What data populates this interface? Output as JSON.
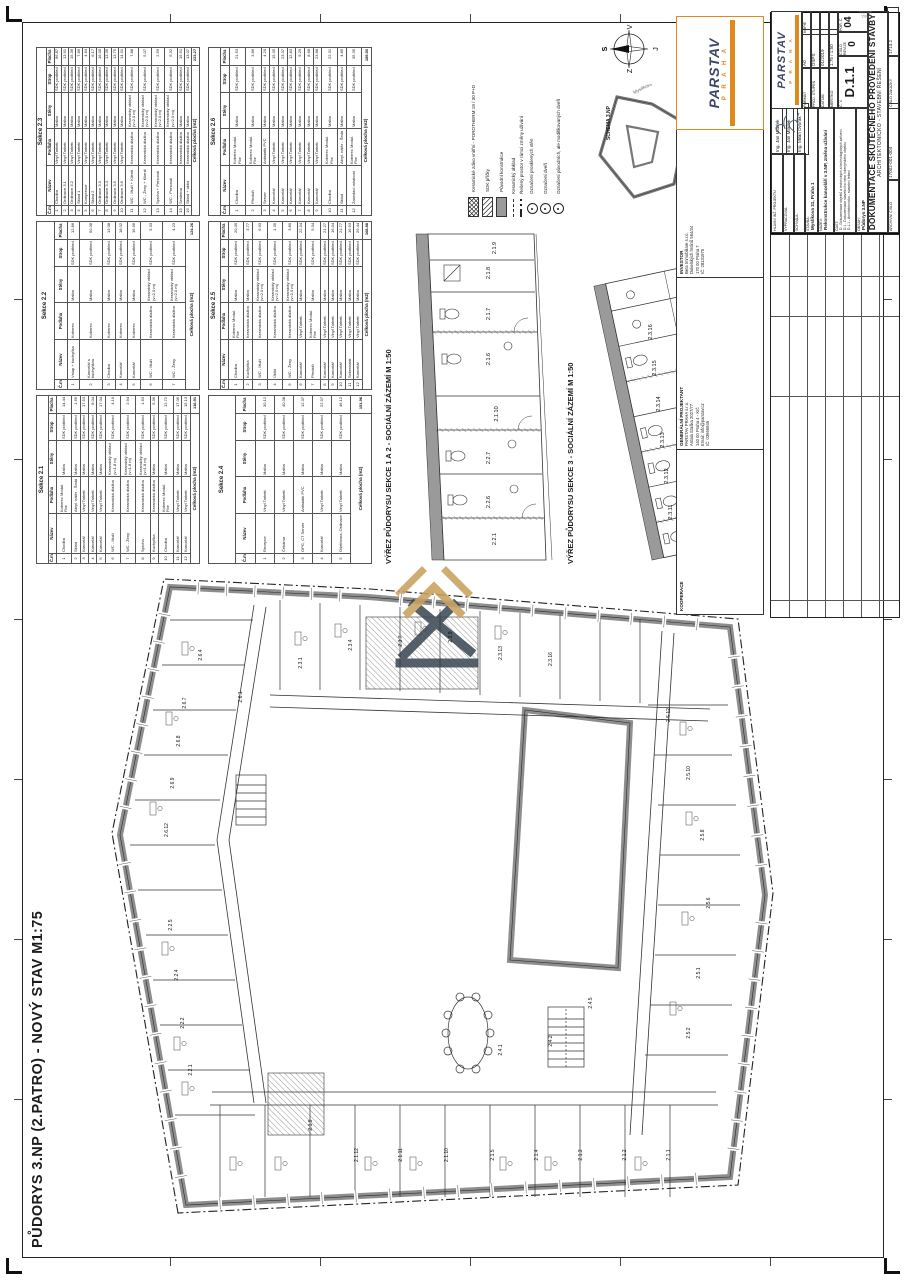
{
  "sheet": {
    "main_title": "PŮDORYS 3.NP (2.PATRO) - NOVÝ STAV M1:75",
    "detail1_title": "VÝŘEZ PŮDORYSU SEKCE 1 A 2 - SOCIÁLNÍ ZÁZEMÍ M 1:50",
    "detail2_title": "VÝŘEZ PŮDORYSU SEKCE 3 - SOCIÁLNÍ ZÁZEMÍ M 1:50",
    "schema_label": "SCHEMA 3.NP",
    "edge_stamp": "17002-001-004"
  },
  "compass": {
    "n": "S",
    "e": "V",
    "s": "J",
    "w": "Z"
  },
  "schema": {
    "streets": [
      "Černá",
      "Myslíkova"
    ]
  },
  "legend": {
    "items": [
      {
        "sw": "cross",
        "label": "Keramické zdivo vnitřní - POROTHERM 19 / 30 P+D"
      },
      {
        "sw": "diag",
        "label": "SDK příčky"
      },
      {
        "sw": "solid",
        "label": "Původní konstrukce"
      },
      {
        "sw": "lineD",
        "label": "Keramický obklad"
      },
      {
        "sw": "dd",
        "label": "Řešený prostor v rámci změny užívání"
      },
      {
        "sw": "circ",
        "label": "Označení prosklených stěn"
      },
      {
        "sw": "circ",
        "label": "Označení dveří"
      },
      {
        "sw": "circ",
        "label": "Označení původních, ale modifikovaných dveří"
      }
    ]
  },
  "tables": {
    "columns": [
      "Č.m.",
      "Název",
      "Podlaha",
      "Stěny",
      "Strop",
      "Plocha"
    ],
    "total_label": "Celková plocha (m2)",
    "sections": [
      {
        "name": "Sekce 2.1",
        "total": "116.91",
        "rows": [
          [
            "1",
            "Chodba",
            "Koberec Modul. Flor",
            "Malba",
            "SDK podhled",
            "14.44"
          ],
          [
            "2",
            "Sklad",
            "Akryl. nátěr - Šedá",
            "Malba",
            "SDK podhled",
            "1.69"
          ],
          [
            "3",
            "Kancelář",
            "Vinyl Tarkett",
            "Malba",
            "SDK podhled",
            "17.53"
          ],
          [
            "4",
            "Kancelář",
            "Vinyl Tarkett",
            "Malba",
            "SDK podhled",
            "8.04"
          ],
          [
            "5",
            "Kancelář",
            "Vinyl Tarkett",
            "Malba",
            "SDK podhled",
            "17.04"
          ],
          [
            "6",
            "WC - Muži",
            "Keramická dlažba",
            "Keramický obklad (v=1.8 m)",
            "SDK podhled",
            "4.19"
          ],
          [
            "7",
            "WC - Ženy",
            "Keramická dlažba",
            "Keramický obklad (v=1.8 m)",
            "SDK podhled",
            "2.94"
          ],
          [
            "8",
            "Sprcha",
            "Keramická dlažba",
            "Keramický obklad (v=1.8 m)",
            "SDK podhled",
            "1.63"
          ],
          [
            "9",
            "Kuchyňka",
            "Keramická dlažba",
            "Malba",
            "SDK podhled",
            "5.36"
          ],
          [
            "10",
            "Chodba",
            "Koberec Modul. Flor",
            "Malba",
            "SDK podhled",
            "12.72"
          ],
          [
            "11",
            "Kancelář",
            "Vinyl Tarkett",
            "Malba",
            "SDK podhled",
            "17.06"
          ],
          [
            "12",
            "Kancelář",
            "Vinyl Tarkett",
            "Malba",
            "SDK podhled",
            "15.13"
          ]
        ]
      },
      {
        "name": "Sekce 2.2",
        "total": "124.26",
        "rows": [
          [
            "1",
            "Vstup + kuchyňka",
            "Koberec",
            "Malba",
            "SDK podhled",
            "12.86"
          ],
          [
            "2",
            "Kancelář s kuchyňkou",
            "Koberec",
            "Malba",
            "SDK podhled",
            "50.38"
          ],
          [
            "3",
            "Chodba",
            "Koberec",
            "Malba",
            "SDK podhled",
            "13.08"
          ],
          [
            "4",
            "Kancelář",
            "Koberec",
            "Malba",
            "SDK podhled",
            "18.02"
          ],
          [
            "5",
            "Kancelář",
            "Koberec",
            "Malba",
            "SDK podhled",
            "16.66"
          ],
          [
            "6",
            "WC - Muži",
            "Keramická dlažba",
            "Keramický obklad (v=2.0 m)",
            "SDK podhled",
            "5.33"
          ],
          [
            "7",
            "WC - Ženy",
            "Keramická dlažba",
            "Keramický obklad (v=2.0 m)",
            "SDK podhled",
            "4.23"
          ]
        ]
      },
      {
        "name": "Sekce 2.3",
        "total": "223.27",
        "rows": [
          [
            "1",
            "Chodba",
            "Vinyl Tarkett",
            "Malba",
            "SDK podhled",
            "66.87"
          ],
          [
            "2",
            "Ordinace 3.1",
            "Vinyl Tarkett",
            "Malba",
            "SDK podhled",
            "13.91"
          ],
          [
            "3",
            "Ordinace 3.2",
            "Vinyl Tarkett",
            "Malba",
            "SDK podhled",
            "15.36"
          ],
          [
            "4",
            "Sklad 1",
            "Vinyl Tarkett",
            "Malba",
            "SDK podhled",
            "7.86"
          ],
          [
            "5",
            "Kompresor",
            "Vinyl Tarkett",
            "Malba",
            "SDK podhled",
            "4.84"
          ],
          [
            "6",
            "Sklad 2",
            "Vinyl Tarkett",
            "Malba",
            "SDK podhled",
            "6.17"
          ],
          [
            "7",
            "Ordinace 3.3",
            "Vinyl Tarkett",
            "Malba",
            "SDK podhled",
            "16.00"
          ],
          [
            "8",
            "Ordinace 3.4",
            "Vinyl Tarkett",
            "Malba",
            "SDK podhled",
            "13.36"
          ],
          [
            "9",
            "Ordinace 3.5",
            "Vinyl Tarkett",
            "Malba",
            "SDK podhled",
            "13.75"
          ],
          [
            "10",
            "Ordinace 3.6",
            "Vinyl Tarkett",
            "Malba",
            "SDK podhled",
            "14.31"
          ],
          [
            "11",
            "WC - Muži + Klienti",
            "Keramická dlažba",
            "Keramický obklad (v=2.0 m)",
            "SDK podhled",
            "7.88"
          ],
          [
            "12",
            "WC - Ženy + Klienti",
            "Keramická dlažba",
            "Keramický obklad (v=2.0 m)",
            "SDK podhled",
            "5.07"
          ],
          [
            "13",
            "Sprcha + Personál",
            "Keramická dlažba",
            "Keramický obklad (v=2.0 m)",
            "SDK podhled",
            "2.59"
          ],
          [
            "14",
            "WC - Personál",
            "Keramická dlažba",
            "Keramický obklad (v=2.0 m)",
            "SDK podhled",
            "6.32"
          ],
          [
            "15",
            "Sesterna",
            "Keramická dlažba",
            "Malba",
            "SDK podhled",
            "15.91"
          ],
          [
            "16",
            "Sklad + úklid",
            "Keramická dlažba",
            "Malba",
            "SDK podhled",
            "13.07"
          ]
        ]
      },
      {
        "name": "Sekce 2.4",
        "total": "151.96",
        "rows": [
          [
            "1",
            "Recepce",
            "Vinyl Tarkett",
            "Malba",
            "SDK podhled",
            "30.12"
          ],
          [
            "2",
            "Čekárna",
            "Vinyl Tarkett",
            "Malba",
            "SDK podhled",
            "40.38"
          ],
          [
            "3",
            "OPG, CT Server",
            "Antistatik PVC",
            "Malba",
            "SDK podhled",
            "12.37"
          ],
          [
            "4",
            "Kancelář",
            "Vinyl Tarkett",
            "Malba",
            "SDK podhled",
            "22.97"
          ],
          [
            "5",
            "Ošetřovna, Ordinace",
            "Vinyl Tarkett",
            "Malba",
            "SDK podhled",
            "46.12"
          ]
        ]
      },
      {
        "name": "Sekce 2.5",
        "total": "168.88",
        "rows": [
          [
            "1",
            "Chodba",
            "Koberec Modul. Flor",
            "Malba",
            "SDK podhled",
            "20.30"
          ],
          [
            "2",
            "Kuchyňka",
            "Keramická dlažba",
            "Malba",
            "SDK podhled",
            "3.77"
          ],
          [
            "3",
            "WC - Muži",
            "Keramická dlažba",
            "Keramický obklad (v=2.0 m)",
            "SDK podhled",
            "6.93"
          ],
          [
            "4",
            "Úklid",
            "Keramická dlažba",
            "Keramický obklad (v=2.0 m)",
            "SDK podhled",
            "1.35"
          ],
          [
            "5",
            "WC - Ženy",
            "Keramická dlažba",
            "Keramický obklad (v=2.0 m)",
            "SDK podhled",
            "3.80"
          ],
          [
            "6",
            "Kancelář",
            "Vinyl Tarkett",
            "Malba",
            "SDK podhled",
            "22.34"
          ],
          [
            "7",
            "Předsíň",
            "Koberec Modul. Flor",
            "Malba",
            "SDK podhled",
            "5.04"
          ],
          [
            "8",
            "Kancelář",
            "Vinyl Tarkett",
            "Malba",
            "SDK podhled",
            "21.27"
          ],
          [
            "9",
            "Kancelář",
            "Vinyl Tarkett",
            "Malba",
            "SDK podhled",
            "16.04"
          ],
          [
            "10",
            "Kancelář",
            "Vinyl Tarkett",
            "Malba",
            "SDK podhled",
            "21.77"
          ],
          [
            "11",
            "Sekretariát",
            "Vinyl Tarkett",
            "Malba",
            "SDK podhled",
            "16.93"
          ],
          [
            "12",
            "Kancelář",
            "Vinyl Tarkett",
            "Malba",
            "SDK podhled",
            "29.44"
          ]
        ]
      },
      {
        "name": "Sekce 2.6",
        "total": "189.50",
        "rows": [
          [
            "1",
            "Chodba",
            "Koberec Modul. Flor",
            "Malba",
            "SDK podhled",
            "21.53"
          ],
          [
            "2",
            "Předsíň",
            "Koberec Modul. Flor",
            "Malba",
            "SDK podhled",
            "3.86"
          ],
          [
            "3",
            "Server",
            "Antistatik PVC",
            "Malba",
            "SDK podhled",
            "4.20"
          ],
          [
            "4",
            "Kancelář",
            "Vinyl Tarkett",
            "Malba",
            "SDK podhled",
            "19.35"
          ],
          [
            "5",
            "Kancelář",
            "Vinyl Tarkett",
            "Malba",
            "SDK podhled",
            "23.37"
          ],
          [
            "6",
            "Kancelář",
            "Vinyl Tarkett",
            "Malba",
            "SDK podhled",
            "12.83"
          ],
          [
            "7",
            "Kancelář",
            "Vinyl Tarkett",
            "Malba",
            "SDK podhled",
            "9.29"
          ],
          [
            "8",
            "Kancelář",
            "Vinyl Tarkett",
            "Malba",
            "SDK podhled",
            "8.68"
          ],
          [
            "9",
            "Kancelář",
            "Vinyl Tarkett",
            "Malba",
            "SDK podhled",
            "23.88"
          ],
          [
            "10",
            "Chodba",
            "Koberec Modul. Flor",
            "Malba",
            "SDK podhled",
            "22.31"
          ],
          [
            "11",
            "Sklad",
            "Akryl. nátěr - Šedá",
            "Malba",
            "SDK podhled",
            "4.85"
          ],
          [
            "12",
            "Zasedací místnost",
            "Koberec Modul. Flor",
            "Malba",
            "SDK podhled",
            "35.35"
          ]
        ]
      }
    ]
  },
  "parties": {
    "investor_label": "INVESTOR",
    "investor_lines": [
      "Beta Immobiliare s.r.o.",
      "Dukelských hrdinů 564/34",
      "170 00 Praha 7",
      "IČ: 28131975"
    ],
    "gp_label": "GENERÁLNÍ PROJEKTANT",
    "gp_lines": [
      "PARSTAV PRAHA s.r.o.",
      "Antala Staška 2027/77",
      "140 00 Praha 4 - Krč",
      "Email: info@parstav.cz",
      "IČ: 03666946"
    ],
    "koop_label": "KOOPERACE"
  },
  "brand": {
    "name": "PARSTAV",
    "sub": "P R A H A",
    "orange": "#e08a1e",
    "ink": "#3f4566"
  },
  "titleblock": {
    "sig_rows": [
      {
        "label": "HLAVNÍ INŽ. PROJEKTU",
        "value": "Ing. Jan Mládek"
      },
      {
        "label": "VYPRACOVAL",
        "value": "Ing. Jan Mládek"
      },
      {
        "label": "SCHVÁLIL",
        "value": "Ing. Milan Dvořák"
      }
    ],
    "stavba_label": "STAVBA:",
    "stavba": "Myslíkova 31, Praha 1",
    "nazev_label": "NÁZEV:",
    "nazev": "Rekonstrukce kanceláří v 3.NP, změna užívání",
    "cast_label": "ČÁST:",
    "cast_lines": [
      "D - Dokumentace objektů a technických a technologických zařízení",
      "D.1 - Dokumentace stavebního nebo inženýrského objektu",
      "D.1.1 - Architektonicko - stavební řešení"
    ],
    "obsah_label": "OBSAH:",
    "obsah": "Půdorys 3.NP",
    "format_label": "FORMÁT",
    "format": "A0",
    "stupen_label": "PROJ. STUPEŇ",
    "stupen": "DSPS",
    "datum_label": "DATUM",
    "datum": "01/2019",
    "meritko_label": "MĚŘÍTKO",
    "meritko": "1:75 / 1:50",
    "kopie_label": "KOPIE",
    "cislo_label": "Č. V.",
    "cislo": "D.1.1",
    "revize_label": "ČÍSLO REVIZE",
    "revize": "0",
    "por_label": "POŘ. Č.",
    "por": "04",
    "doc_title": "DOKUMENTACE SKUTEČNÉHO PROVEDENÍ STAVBY",
    "doc_sub": "ARCHITEKTONICKO - STAVEBNÍ ŘEŠENÍ",
    "arch_label": "ARCHIVNÍ ČÍSLO",
    "arch": "17002-001-004",
    "zakazka_label": "ČÍSLO ZAKÁZKY",
    "zakazka": "1713.2"
  },
  "plan": {
    "main_labels": [
      [
        "2.1.1",
        100,
        600
      ],
      [
        "2.1.2",
        100,
        556
      ],
      [
        "2.1.3",
        100,
        512
      ],
      [
        "2.1.4",
        100,
        468
      ],
      [
        "2.1.5",
        100,
        424
      ],
      [
        "2.1.9",
        130,
        242
      ],
      [
        "2.1.10",
        100,
        378
      ],
      [
        "2.1.11",
        100,
        332
      ],
      [
        "2.1.12",
        100,
        288
      ],
      [
        "2.2.1",
        185,
        122
      ],
      [
        "2.2.2",
        232,
        114
      ],
      [
        "2.2.4",
        280,
        108
      ],
      [
        "2.2.5",
        330,
        102
      ],
      [
        "2.6.12",
        425,
        98
      ],
      [
        "2.6.9",
        472,
        104
      ],
      [
        "2.6.8",
        514,
        110
      ],
      [
        "2.6.7",
        552,
        116
      ],
      [
        "2.6.4",
        600,
        132
      ],
      [
        "2.6.1",
        558,
        172
      ],
      [
        "2.3.1",
        592,
        232
      ],
      [
        "2.3.4",
        610,
        282
      ],
      [
        "2.3.7",
        614,
        332
      ],
      [
        "2.3.9",
        618,
        382
      ],
      [
        "2.3.13",
        602,
        432
      ],
      [
        "2.3.16",
        596,
        482
      ],
      [
        "2.4.1",
        205,
        432
      ],
      [
        "2.4.2",
        214,
        482
      ],
      [
        "2.4.5",
        252,
        522
      ],
      [
        "2.5.12",
        540,
        600
      ],
      [
        "2.5.10",
        482,
        620
      ],
      [
        "2.5.8",
        420,
        634
      ],
      [
        "2.5.6",
        352,
        640
      ],
      [
        "2.5.2",
        222,
        620
      ],
      [
        "2.5.1",
        282,
        630
      ]
    ],
    "detail1_labels": [
      [
        "2.2.1",
        25,
        102
      ],
      [
        "2.2.6",
        62,
        96
      ],
      [
        "2.2.7",
        106,
        96
      ],
      [
        "2.1.10",
        150,
        104
      ],
      [
        "2.1.6",
        205,
        96
      ],
      [
        "2.1.7",
        250,
        96
      ],
      [
        "2.1.8",
        291,
        96
      ],
      [
        "2.1.9",
        316,
        102
      ]
    ],
    "detail2_labels": [
      [
        "2.3.11",
        52,
        96
      ],
      [
        "2.3.12",
        88,
        92
      ],
      [
        "2.3.13",
        124,
        88
      ],
      [
        "2.3.14",
        160,
        84
      ],
      [
        "2.3.15",
        196,
        80
      ],
      [
        "2.3.16",
        232,
        76
      ],
      [
        "2.3.1",
        140,
        128
      ]
    ]
  }
}
